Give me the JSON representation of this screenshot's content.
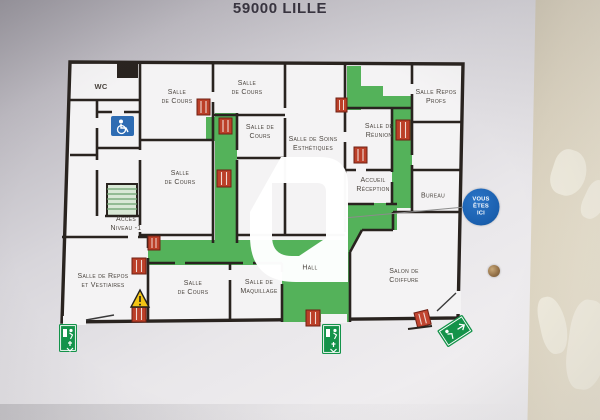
{
  "title": "59000 LILLE",
  "badge": {
    "label": "VOUS\nÊTES\nICI"
  },
  "rooms": [
    {
      "id": "wc",
      "label": "WC"
    },
    {
      "id": "salle-de-cours-1",
      "label": "Salle\nde Cours"
    },
    {
      "id": "salle-de-cours-2",
      "label": "Salle\nde Cours"
    },
    {
      "id": "salle-de-cours-3",
      "label": "Salle de\nCours"
    },
    {
      "id": "salle-de-soins-esthetiques",
      "label": "Salle de Soins\nEsthétiques"
    },
    {
      "id": "salle-de-reunion",
      "label": "Salle de\nRéunion"
    },
    {
      "id": "salle-repos-profs",
      "label": "Salle Repos\nProfs"
    },
    {
      "id": "accueil-reception",
      "label": "Accueil\nRéception"
    },
    {
      "id": "bureau",
      "label": "Bureau"
    },
    {
      "id": "salle-de-cours-4",
      "label": "Salle\nde Cours"
    },
    {
      "id": "acces-niveau-1",
      "label": "Accès\nNiveau -1"
    },
    {
      "id": "salle-de-repos-et-vestiaires",
      "label": "Salle de Repos\net Vestiaires"
    },
    {
      "id": "salle-de-cours-5",
      "label": "Salle\nde Cours"
    },
    {
      "id": "salle-de-maquillage",
      "label": "Salle de\nMaquillage"
    },
    {
      "id": "hall",
      "label": "Hall"
    },
    {
      "id": "salon-de-coiffure",
      "label": "Salon de\nCoiffure"
    }
  ],
  "icons": [
    "exit-running-man-icon",
    "radiator-icon",
    "accessibility-icon",
    "stairs-icon",
    "warning-triangle-icon",
    "screw-hole",
    "watermark-logo"
  ],
  "colors": {
    "evacuation_green": "#54b25a",
    "exit_sign_green": "#14934a",
    "wall_line": "#29231f",
    "radiator_red": "#bb3f28",
    "badge_blue": "#1a63b5",
    "accessibility_blue": "#2e6cb3",
    "warning_yellow": "#f2c414",
    "right_wall_beige": "#ddd5c2",
    "board_grey": "#e9e7ea"
  }
}
